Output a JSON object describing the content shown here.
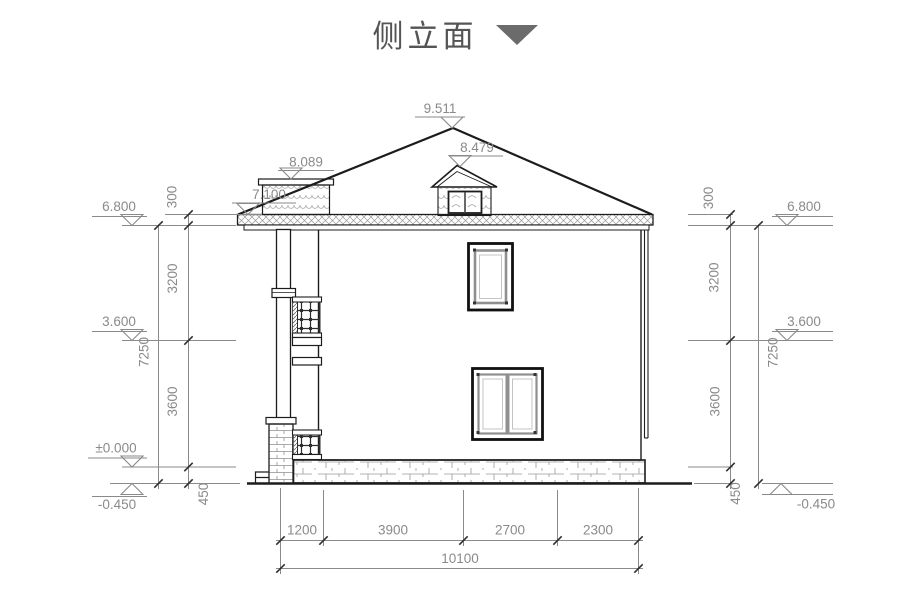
{
  "title": {
    "label": "侧立面"
  },
  "levels": {
    "roof_peak": "9.511",
    "dormer_top": "8.479",
    "parapet_top": "8.089",
    "eave_top": "7.100",
    "eave": "6.800",
    "second_floor": "3.600",
    "ground_floor": "±0.000",
    "site": "-0.450"
  },
  "vertical_dims": {
    "segments": [
      "300",
      "3200",
      "3600",
      "450"
    ],
    "total": "7250"
  },
  "horizontal_dims": {
    "segments": [
      "1200",
      "3900",
      "2700",
      "2300"
    ],
    "total": "10100"
  },
  "colors": {
    "line": "#1c1c1c",
    "dimension": "#8a8a8a",
    "title": "#545454"
  }
}
